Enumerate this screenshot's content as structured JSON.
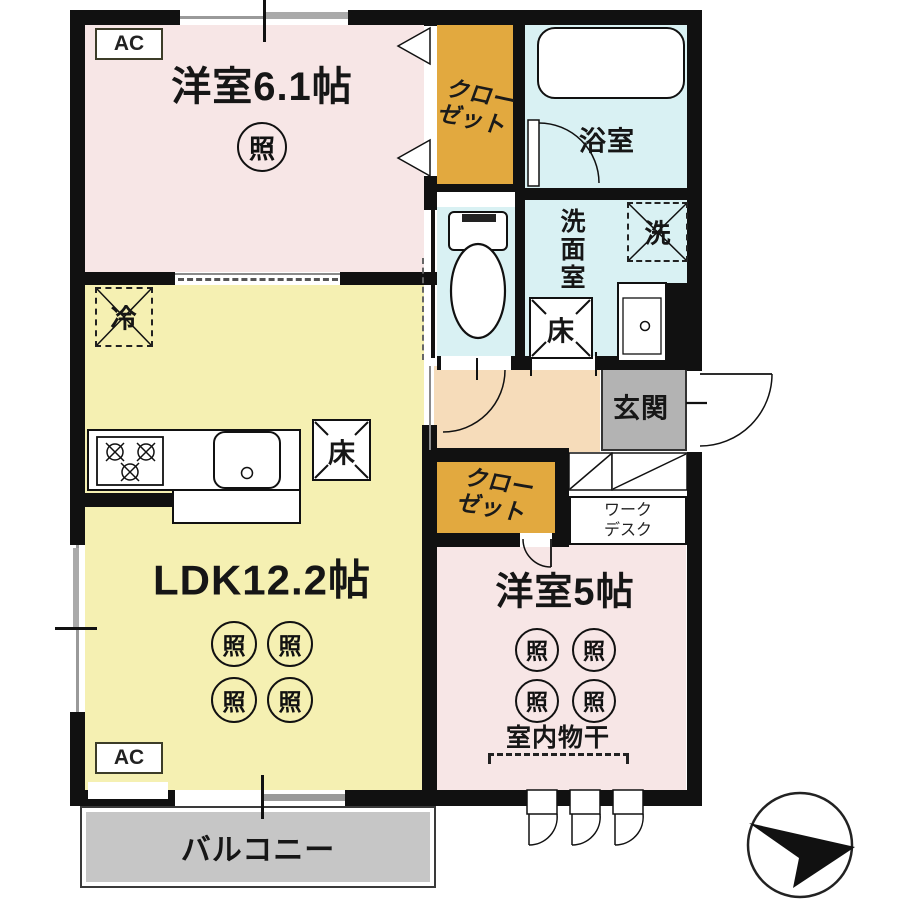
{
  "plan_type": "apartment-floor-plan",
  "labels": {
    "ac": "AC",
    "bedroom1": "洋室6.1帖",
    "ldk": "LDK12.2帖",
    "bedroom2": "洋室5帖",
    "bathroom": "浴室",
    "washroom": "洗面室",
    "entrance": "玄関",
    "balcony": "バルコニー",
    "closet_line1": "クロー",
    "closet_line2": "ゼット",
    "desk_line1": "ワーク",
    "desk_line2": "デスク",
    "light": "照",
    "fridge": "冷",
    "washer": "洗",
    "floor_hatch": "床",
    "indoor_drying": "室内物干"
  },
  "colors": {
    "room_pink": "#f7e6e6",
    "ldk_yellow": "#f5f0b2",
    "wet_blue": "#d9f1f3",
    "closet_orange": "#e2a93f",
    "hall_peach": "#f6dcba",
    "entrance_gray": "#b3b3b3",
    "balcony_gray": "#c6c6c6",
    "wall": "#111111"
  },
  "icons": [
    "north-arrow-compass",
    "bathtub",
    "toilet",
    "kitchen-sink",
    "gas-stove",
    "washbasin"
  ]
}
